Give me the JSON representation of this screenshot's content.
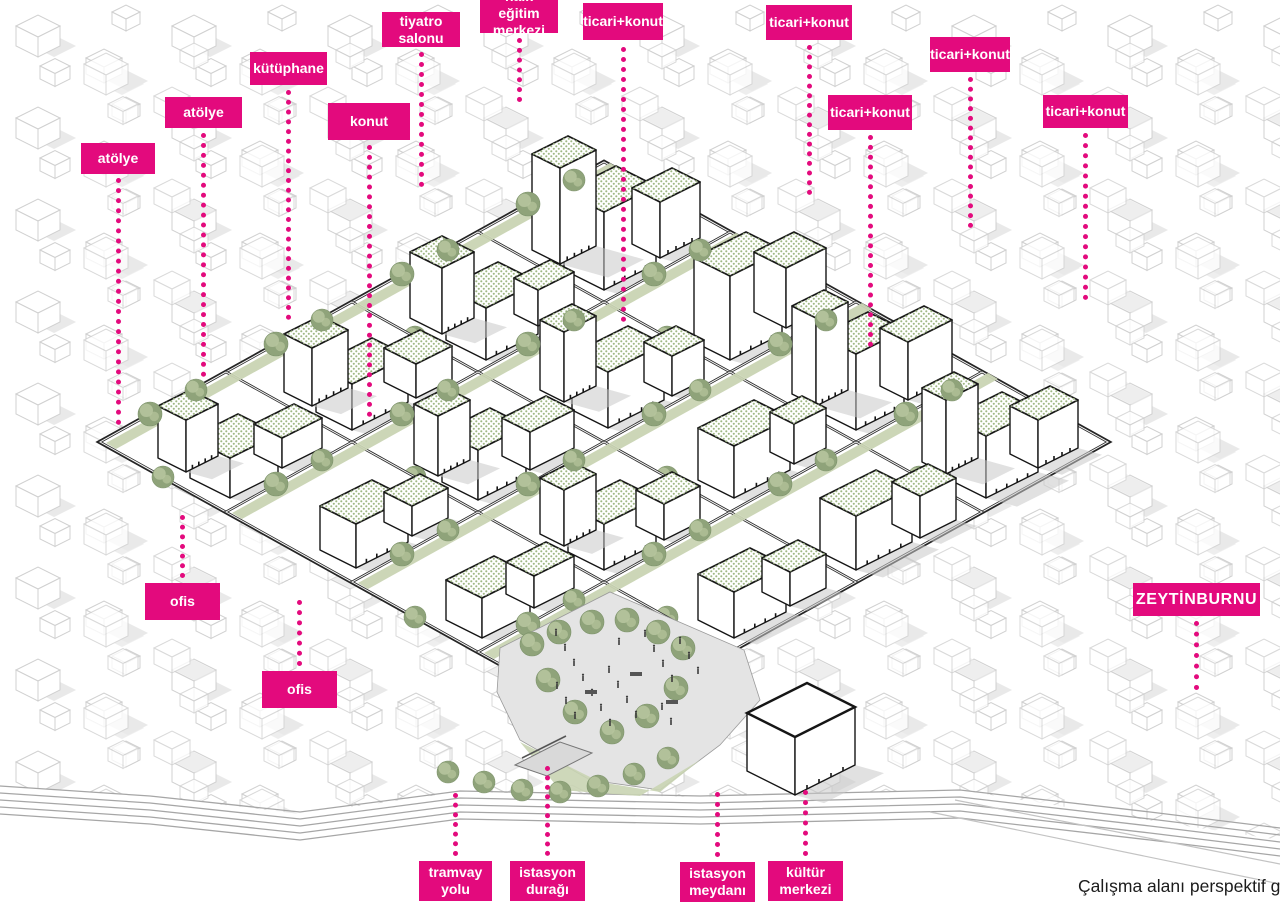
{
  "caption": "Çalışma alanı perspektif görünü",
  "colors": {
    "accent": "#e30a7d",
    "dev_line": "#161616",
    "context_line": "#c3c3c3",
    "context_shadow": "#e3e3e3",
    "building_shadow": "#c8c8c8",
    "roof_dot": "#9fb885",
    "tree_dark": "#8fa37a",
    "tree_light": "#b6c49d",
    "lawn": "#c9d4b3",
    "plaza": "#e4e4e4",
    "road": "#2b2b2b",
    "tram": "#a6a6a6",
    "crowd": "#3c3c3c"
  },
  "labels": [
    {
      "id": "atolye-1",
      "text": "atölye",
      "x": 81,
      "y": 143,
      "w": 74,
      "h": 31,
      "leader": {
        "y1": 178,
        "y2": 425
      }
    },
    {
      "id": "atolye-2",
      "text": "atölye",
      "x": 165,
      "y": 97,
      "w": 77,
      "h": 31,
      "leader": {
        "y1": 133,
        "y2": 377
      }
    },
    {
      "id": "kutuphane",
      "text": "kütüphane",
      "x": 250,
      "y": 52,
      "w": 77,
      "h": 33,
      "leader": {
        "y1": 90,
        "y2": 320
      }
    },
    {
      "id": "konut",
      "text": "konut",
      "x": 328,
      "y": 103,
      "w": 82,
      "h": 37,
      "leader": {
        "y1": 145,
        "y2": 417
      }
    },
    {
      "id": "tiyatro-salonu",
      "text": "tiyatro\nsalonu",
      "x": 382,
      "y": 12,
      "w": 78,
      "h": 35,
      "leader": {
        "y1": 52,
        "y2": 187
      }
    },
    {
      "id": "halk-egitim-merkezi",
      "text": "halk eğitim\nmerkezi",
      "x": 480,
      "y": -6,
      "w": 78,
      "h": 39,
      "leader": {
        "y1": 38,
        "y2": 102
      }
    },
    {
      "id": "ticari-konut-1",
      "text": "ticari+konut",
      "x": 583,
      "y": 3,
      "w": 80,
      "h": 37,
      "leader": {
        "y1": 47,
        "y2": 322
      }
    },
    {
      "id": "ticari-konut-2",
      "text": "ticari+konut",
      "x": 766,
      "y": 5,
      "w": 86,
      "h": 35,
      "leader": {
        "y1": 45,
        "y2": 195
      }
    },
    {
      "id": "ticari-konut-3",
      "text": "ticari+konut",
      "x": 930,
      "y": 37,
      "w": 80,
      "h": 35,
      "leader": {
        "y1": 77,
        "y2": 228
      }
    },
    {
      "id": "ticari-konut-4",
      "text": "ticari+konut",
      "x": 828,
      "y": 95,
      "w": 84,
      "h": 35,
      "leader": {
        "y1": 135,
        "y2": 347
      }
    },
    {
      "id": "ticari-konut-5",
      "text": "ticari+konut",
      "x": 1043,
      "y": 95,
      "w": 85,
      "h": 33,
      "leader": {
        "y1": 133,
        "y2": 300
      }
    },
    {
      "id": "ofis-1",
      "text": "ofis",
      "x": 145,
      "y": 583,
      "w": 75,
      "h": 37,
      "leader": {
        "y1": 515,
        "y2": 578
      }
    },
    {
      "id": "ofis-2",
      "text": "ofis",
      "x": 262,
      "y": 671,
      "w": 75,
      "h": 37,
      "leader": {
        "y1": 600,
        "y2": 666
      }
    },
    {
      "id": "zeytinburnu",
      "text": "ZEYTİNBURNU",
      "x": 1133,
      "y": 583,
      "w": 127,
      "h": 33,
      "variant": "large",
      "leader": {
        "y1": 621,
        "y2": 690
      }
    },
    {
      "id": "tramvay-yolu",
      "text": "tramvay\nyolu",
      "x": 419,
      "y": 861,
      "w": 73,
      "h": 40,
      "leader": {
        "y1": 793,
        "y2": 856
      }
    },
    {
      "id": "istasyon-duragi",
      "text": "istasyon\ndurağı",
      "x": 510,
      "y": 861,
      "w": 75,
      "h": 40,
      "leader": {
        "y1": 766,
        "y2": 856
      }
    },
    {
      "id": "istasyon-meydani",
      "text": "istasyon\nmeydanı",
      "x": 680,
      "y": 862,
      "w": 75,
      "h": 40,
      "leader": {
        "y1": 792,
        "y2": 857
      }
    },
    {
      "id": "kultur-merkezi",
      "text": "kültür\nmerkezi",
      "x": 768,
      "y": 861,
      "w": 75,
      "h": 40,
      "leader": {
        "y1": 790,
        "y2": 856
      }
    }
  ]
}
